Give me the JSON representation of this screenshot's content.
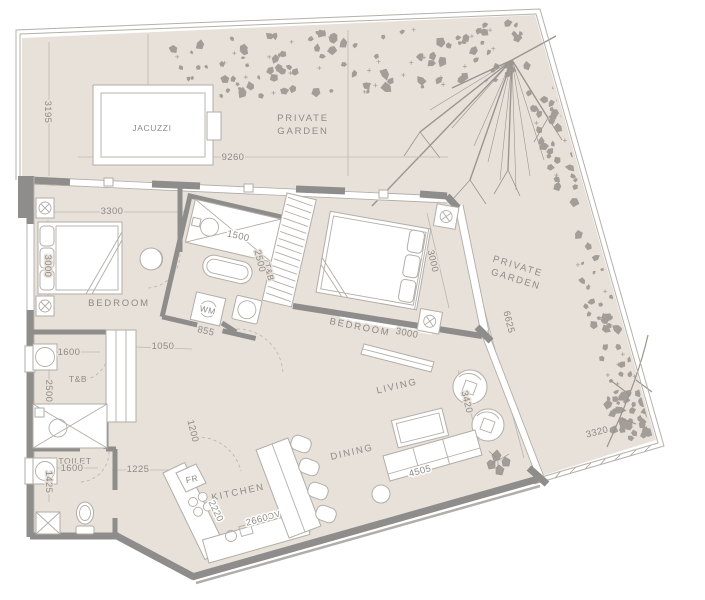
{
  "rooms": {
    "jacuzzi": "JACUZZI",
    "private_garden_line1": "PRIVATE",
    "private_garden_line2": "GARDEN",
    "bedroom_left": "BEDROOM",
    "bedroom_right": "BEDROOM",
    "tb_left": "T&B",
    "tb_center": "T&B",
    "toilet": "TOILET",
    "kitchen": "KITCHEN",
    "dining": "DINING",
    "living": "LIVING",
    "wm": "WM",
    "fr": "FR",
    "ov": "OV"
  },
  "dimensions": {
    "jacuzzi_depth": "3195",
    "garden_top_width": "9260",
    "bedroom_left_width": "3300",
    "bedroom_left_depth": "3000",
    "bath_center_width": "1500",
    "bath_center_depth": "2500",
    "wm_niche": "855",
    "hall_width": "1050",
    "tb_left_width": "1600",
    "tb_left_depth": "2500",
    "toilet_width": "1600",
    "toilet_depth": "1425",
    "hall_bottom_width": "1225",
    "entry_width": "1200",
    "kitchen_depth": "2220",
    "kitchen_width": "2660",
    "bedroom_right_depth": "3000",
    "bedroom_right_width": "3000",
    "garden_right_length": "6625",
    "living_depth": "3420",
    "sofa_wall_width": "4505",
    "garden_bottom_width": "3320"
  },
  "colors": {
    "floor": "#e8e1da",
    "wall": "#8e8d8b",
    "furniture_line": "#b2ada7",
    "text": "#8e8a85",
    "foliage": "#a29d97",
    "boundary": "#b5b0aa",
    "white": "#ffffff"
  }
}
